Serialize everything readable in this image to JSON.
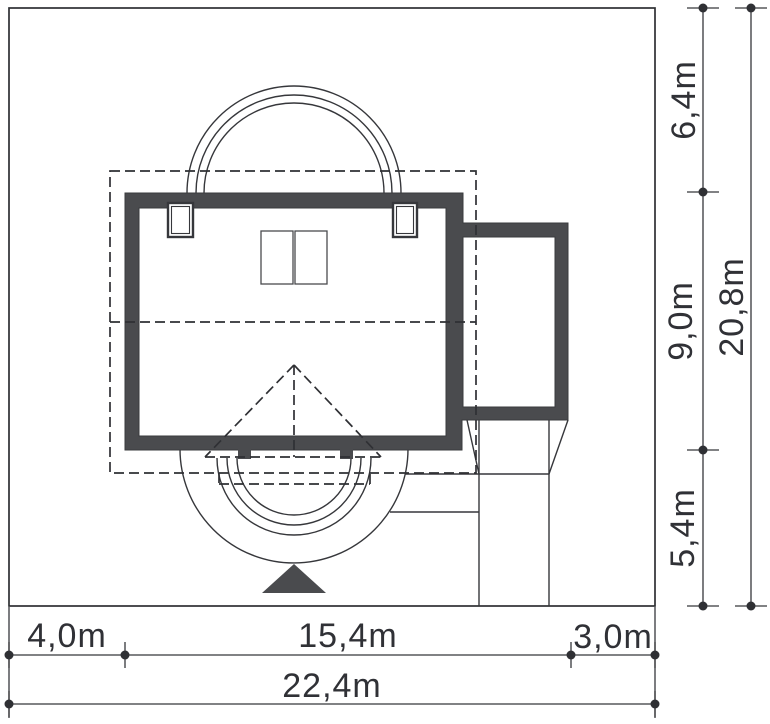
{
  "colors": {
    "wall": "#4a4b4e",
    "line": "#36373b",
    "text": "#303136",
    "background": "#ffffff"
  },
  "dimensions": {
    "right": [
      {
        "label": "6,4m"
      },
      {
        "label": "9,0m"
      },
      {
        "label": "5,4m"
      }
    ],
    "right_total": {
      "label": "20,8m"
    },
    "bottom": [
      {
        "label": "4,0m"
      },
      {
        "label": "15,4m"
      },
      {
        "label": "3,0m"
      }
    ],
    "bottom_total": {
      "label": "22,4m"
    }
  }
}
